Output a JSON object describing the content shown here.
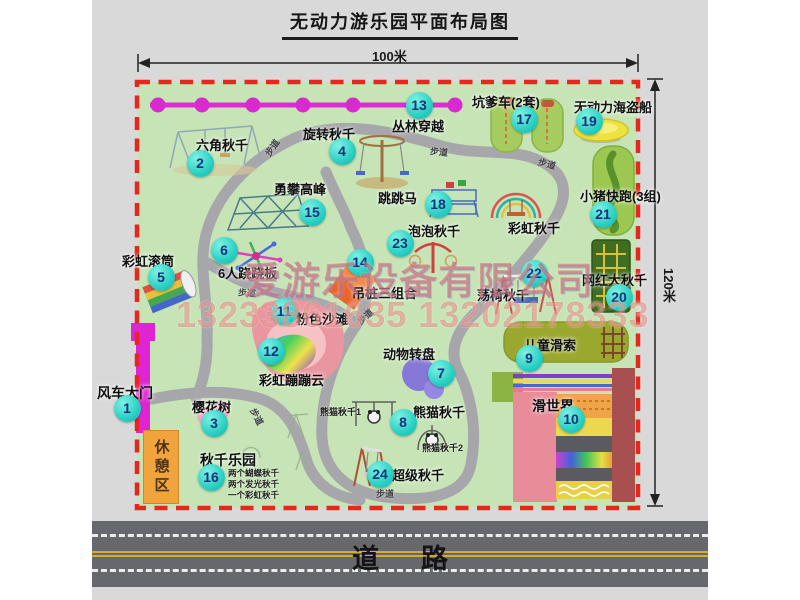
{
  "title": "无动力游乐园平面布局图",
  "dimensions": {
    "top": "100米",
    "right": "120米"
  },
  "road": {
    "label": "道路"
  },
  "rest_area": {
    "label": "休憩区"
  },
  "watermark": {
    "company": "爱游乐设备有限公司",
    "phones": "13233861635 13202178333"
  },
  "attractions": [
    {
      "num": "1",
      "label": "风车大门",
      "label_x": 97,
      "label_y": 383,
      "badge_x": 127,
      "badge_y": 408,
      "size": 14
    },
    {
      "num": "2",
      "label": "六角秋千",
      "label_x": 196,
      "label_y": 135,
      "badge_x": 200,
      "badge_y": 163
    },
    {
      "num": "3",
      "label": "樱花树",
      "label_x": 192,
      "label_y": 397,
      "badge_x": 214,
      "badge_y": 423
    },
    {
      "num": "4",
      "label": "旋转秋千",
      "label_x": 303,
      "label_y": 124,
      "badge_x": 342,
      "badge_y": 151
    },
    {
      "num": "5",
      "label": "彩虹滚筒",
      "label_x": 122,
      "label_y": 251,
      "badge_x": 161,
      "badge_y": 277
    },
    {
      "num": "6",
      "label": "6人跷跷板",
      "label_x": 218,
      "label_y": 263,
      "badge_x": 224,
      "badge_y": 250
    },
    {
      "num": "7",
      "label": "动物转盘",
      "label_x": 383,
      "label_y": 344,
      "badge_x": 441,
      "badge_y": 373
    },
    {
      "num": "8",
      "label": "熊猫秋千",
      "label_x": 413,
      "label_y": 402,
      "badge_x": 403,
      "badge_y": 422
    },
    {
      "num": "9",
      "label": "儿童滑索",
      "label_x": 524,
      "label_y": 335,
      "badge_x": 529,
      "badge_y": 358
    },
    {
      "num": "10",
      "label": "滑世界",
      "label_x": 532,
      "label_y": 396,
      "size": 14,
      "badge_x": 571,
      "badge_y": 419
    },
    {
      "num": "11",
      "label": "粉色沙滩",
      "label_x": 296,
      "label_y": 309,
      "badge_x": 284,
      "badge_y": 311
    },
    {
      "num": "12",
      "label": "彩虹蹦蹦云",
      "label_x": 259,
      "label_y": 370,
      "badge_x": 271,
      "badge_y": 351
    },
    {
      "num": "13",
      "label": "丛林穿越",
      "label_x": 392,
      "label_y": 116,
      "badge_x": 419,
      "badge_y": 105
    },
    {
      "num": "14",
      "label": "吊桩三组合",
      "label_x": 352,
      "label_y": 283,
      "badge_x": 360,
      "badge_y": 262
    },
    {
      "num": "15",
      "label": "勇攀高峰",
      "label_x": 274,
      "label_y": 179,
      "badge_x": 312,
      "badge_y": 212
    },
    {
      "num": "16",
      "label": "秋千乐园",
      "label_x": 200,
      "label_y": 450,
      "size": 14,
      "badge_x": 211,
      "badge_y": 477
    },
    {
      "num": "17",
      "label": "坑爹车(2套)",
      "label_x": 472,
      "label_y": 92,
      "badge_x": 524,
      "badge_y": 119
    },
    {
      "num": "18",
      "label": "跳跳马",
      "label_x": 378,
      "label_y": 188,
      "badge_x": 438,
      "badge_y": 204
    },
    {
      "num": "19",
      "label": "无动力海盗船",
      "label_x": 574,
      "label_y": 97,
      "badge_x": 589,
      "badge_y": 121
    },
    {
      "num": "20",
      "label": "网红大秋千",
      "label_x": 582,
      "label_y": 270,
      "badge_x": 619,
      "badge_y": 297
    },
    {
      "num": "21",
      "label": "小猪快跑(3组)",
      "label_x": 580,
      "label_y": 186,
      "badge_x": 603,
      "badge_y": 214
    },
    {
      "num": "22",
      "label": "荡椅秋千",
      "label_x": 477,
      "label_y": 285,
      "badge_x": 534,
      "badge_y": 273
    },
    {
      "num": "23",
      "label": "泡泡秋千",
      "label_x": 408,
      "label_y": 221,
      "badge_x": 400,
      "badge_y": 243
    },
    {
      "num": "24",
      "label": "超级秋千",
      "label_x": 392,
      "label_y": 465,
      "badge_x": 380,
      "badge_y": 474
    },
    {
      "num": null,
      "id": "rainbow-swing",
      "label": "彩虹秋千",
      "label_x": 508,
      "label_y": 218
    }
  ],
  "sub_labels": [
    {
      "text": "熊猫秋千1",
      "x": 320,
      "y": 405,
      "size": 9
    },
    {
      "text": "熊猫秋千2",
      "x": 422,
      "y": 441,
      "size": 9
    },
    {
      "text": "两个蝴蝶秋千",
      "x": 228,
      "y": 467,
      "size": 8.5
    },
    {
      "text": "两个发光秋千",
      "x": 228,
      "y": 478,
      "size": 8.5
    },
    {
      "text": "一个彩虹秋千",
      "x": 228,
      "y": 489,
      "size": 8.5
    }
  ],
  "path_labels": [
    {
      "text": "步道",
      "x": 263,
      "y": 141,
      "rot": -55
    },
    {
      "text": "步道",
      "x": 430,
      "y": 145,
      "rot": 6
    },
    {
      "text": "步道",
      "x": 538,
      "y": 157,
      "rot": 15
    },
    {
      "text": "步道",
      "x": 238,
      "y": 286,
      "rot": 4
    },
    {
      "text": "步道",
      "x": 248,
      "y": 410,
      "rot": 62
    },
    {
      "text": "步道",
      "x": 376,
      "y": 487,
      "rot": 0
    },
    {
      "text": "步道",
      "x": 356,
      "y": 310,
      "rot": -42
    }
  ]
}
